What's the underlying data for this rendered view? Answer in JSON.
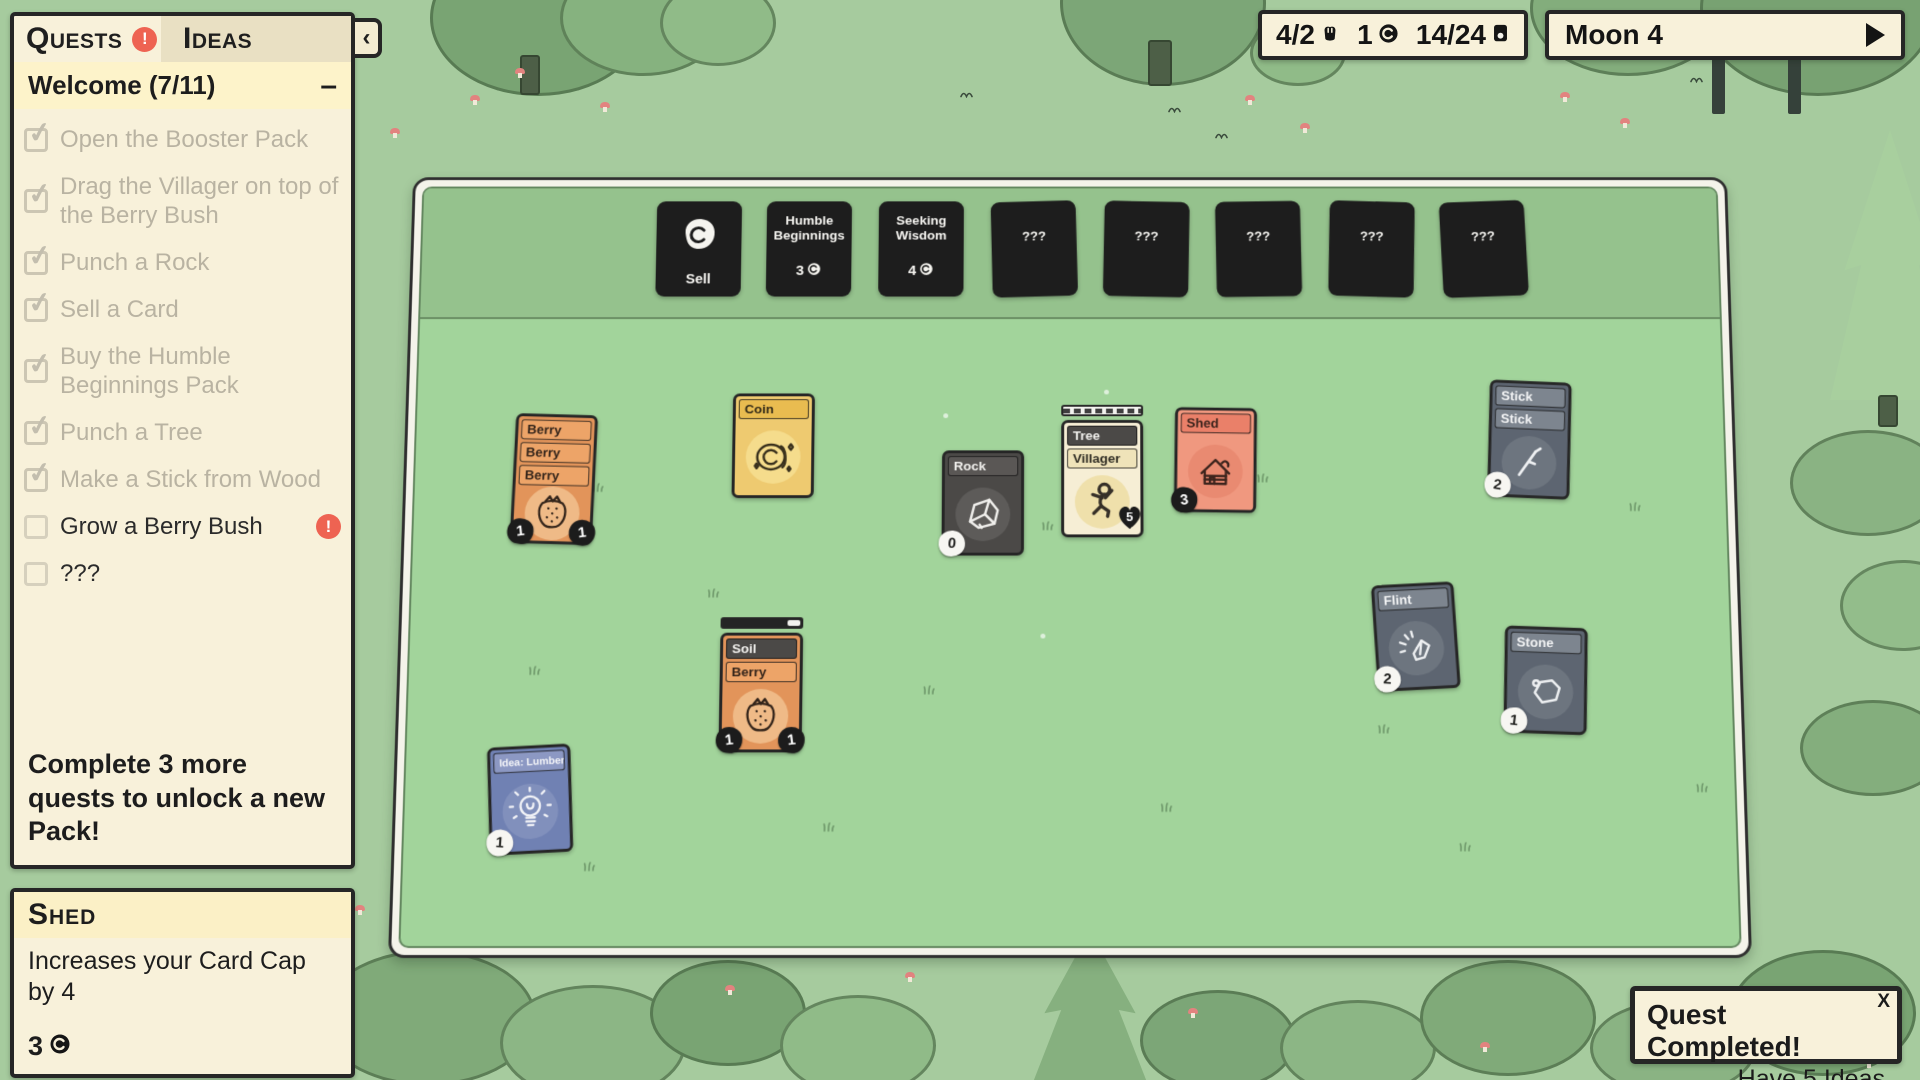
{
  "quests_panel": {
    "tabs": [
      {
        "label": "Quests",
        "has_alert": true
      },
      {
        "label": "Ideas",
        "has_alert": false
      }
    ],
    "alert_glyph": "!",
    "collapse_arrow": "‹",
    "group": {
      "title": "Welcome (7/11)",
      "collapse_glyph": "–"
    },
    "items": [
      {
        "label": "Open the Booster Pack",
        "done": true
      },
      {
        "label": "Drag the Villager on top of the Berry Bush",
        "done": true
      },
      {
        "label": "Punch a Rock",
        "done": true
      },
      {
        "label": "Sell a Card",
        "done": true
      },
      {
        "label": "Buy the Humble Beginnings Pack",
        "done": true
      },
      {
        "label": "Punch a Tree",
        "done": true
      },
      {
        "label": "Make a Stick from Wood",
        "done": true
      },
      {
        "label": "Grow a Berry Bush",
        "done": false,
        "alert": true
      },
      {
        "label": "???",
        "done": false
      }
    ],
    "footer": "Complete 3 more quests to unlock a new Pack!"
  },
  "card_info_panel": {
    "title": "Shed",
    "description": "Increases your Card Cap by 4",
    "sell_value": "3"
  },
  "top_bar": {
    "food": "4/2",
    "coins": "1",
    "cards": "14/24"
  },
  "moon_panel": {
    "label": "Moon 4"
  },
  "packs": [
    {
      "name": "Sell",
      "style": "sell",
      "x": 242,
      "y": 14,
      "rot": 0
    },
    {
      "name": "Humble Beginnings",
      "style": "cost",
      "cost": "3",
      "x": 356,
      "y": 14,
      "rot": 0
    },
    {
      "name": "Seeking Wisdom",
      "style": "cost",
      "cost": "4",
      "x": 472,
      "y": 14,
      "rot": 0
    },
    {
      "name": "???",
      "style": "unknown",
      "x": 589,
      "y": 14,
      "rot": -1.5
    },
    {
      "name": "???",
      "style": "unknown",
      "x": 705,
      "y": 14,
      "rot": 1.2
    },
    {
      "name": "???",
      "style": "unknown",
      "x": 821,
      "y": 14,
      "rot": -0.8
    },
    {
      "name": "???",
      "style": "unknown",
      "x": 938,
      "y": 14,
      "rot": 1.6
    },
    {
      "name": "???",
      "style": "unknown",
      "x": 1054,
      "y": 14,
      "rot": -2
    }
  ],
  "board_cards": [
    {
      "name": "berry-stack",
      "x": 100,
      "y": 241,
      "rot": 1.5,
      "theme": "orange",
      "titles": [
        "Berry",
        "Berry",
        "Berry"
      ],
      "art": "strawberry",
      "badges": [
        {
          "style": "black",
          "value": "1",
          "pos": "left"
        },
        {
          "style": "black",
          "value": "1",
          "pos": "right"
        }
      ]
    },
    {
      "name": "coin-card",
      "x": 324,
      "y": 219,
      "rot": 0,
      "theme": "gold",
      "titles": [
        "Coin"
      ],
      "art": "coin",
      "badges": []
    },
    {
      "name": "rock-card",
      "x": 539,
      "y": 279,
      "rot": 0,
      "theme": "dark",
      "titles": [
        "Rock"
      ],
      "art": "rock",
      "badges": [
        {
          "style": "white",
          "value": "0",
          "pos": "left"
        }
      ]
    },
    {
      "name": "tree-villager-stack",
      "x": 661,
      "y": 231,
      "rot": 0,
      "theme": "cream",
      "titles": [
        {
          "label": "Tree",
          "theme": "dark"
        },
        {
          "label": "Villager",
          "theme": "cream"
        }
      ],
      "art": "villager",
      "progress": {
        "style": "hatched"
      },
      "badges": [
        {
          "style": "heart",
          "value": "5",
          "pos": "right"
        }
      ]
    },
    {
      "name": "shed-card",
      "x": 777,
      "y": 234,
      "rot": 1,
      "theme": "salmon",
      "titles": [
        "Shed"
      ],
      "art": "house",
      "badges": [
        {
          "style": "black",
          "value": "3",
          "pos": "left"
        }
      ]
    },
    {
      "name": "stick-stack",
      "x": 1099,
      "y": 206,
      "rot": 2.5,
      "theme": "slate",
      "titles": [
        "Stick",
        "Stick"
      ],
      "art": "stick",
      "badges": [
        {
          "style": "white",
          "value": "2",
          "pos": "left"
        }
      ]
    },
    {
      "name": "soil-berry-stack",
      "x": 315,
      "y": 453,
      "rot": 0,
      "theme": "orange",
      "titles": [
        {
          "label": "Soil",
          "theme": "dark"
        },
        {
          "label": "Berry",
          "theme": "orange"
        }
      ],
      "art": "strawberry",
      "progress": {
        "style": "dark",
        "value": 0.84
      },
      "badges": [
        {
          "style": "black",
          "value": "1",
          "pos": "left"
        },
        {
          "style": "black",
          "value": "1",
          "pos": "right"
        }
      ]
    },
    {
      "name": "flint-card",
      "x": 979,
      "y": 418,
      "rot": -3,
      "theme": "slate",
      "titles": [
        "Flint"
      ],
      "art": "flint",
      "badges": [
        {
          "style": "white",
          "value": "2",
          "pos": "left"
        }
      ]
    },
    {
      "name": "stone-card",
      "x": 1110,
      "y": 463,
      "rot": 2,
      "theme": "slate",
      "titles": [
        "Stone"
      ],
      "art": "stone",
      "badges": [
        {
          "style": "white",
          "value": "1",
          "pos": "left"
        }
      ]
    },
    {
      "name": "idea-lumber-camp-card",
      "x": 84,
      "y": 585,
      "rot": -3,
      "theme": "blue",
      "titles": [
        "Idea: Lumber Camp"
      ],
      "art": "bulb",
      "badges": [
        {
          "style": "white",
          "value": "1",
          "pos": "left"
        }
      ]
    }
  ],
  "toast": {
    "title": "Quest Completed!",
    "subtitle": "Have 5 Ideas",
    "close_glyph": "X"
  }
}
